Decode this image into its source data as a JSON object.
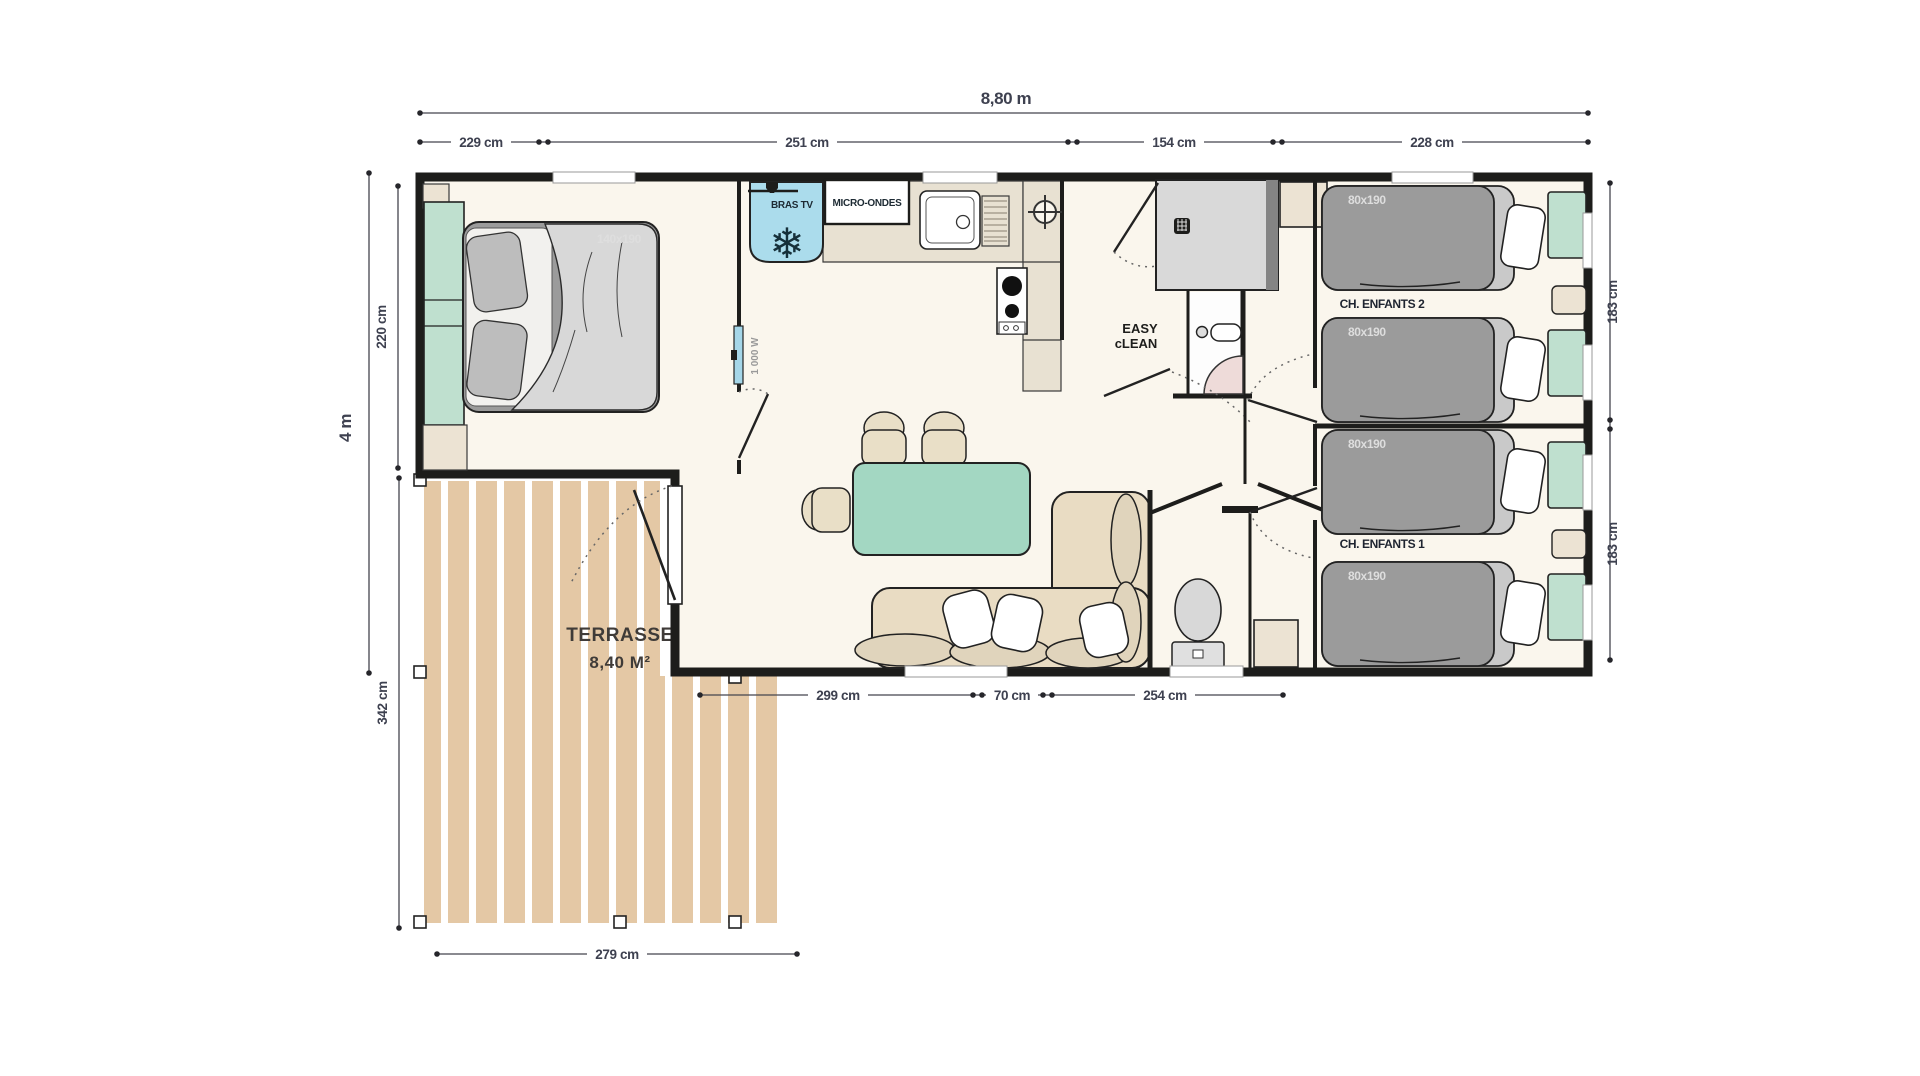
{
  "dimensions": {
    "total_width": "8,80 m",
    "top_segments": [
      "229 cm",
      "251 cm",
      "154 cm",
      "228 cm"
    ],
    "total_height": "4 m",
    "bedroom_height": "220 cm",
    "terrace_height": "342 cm",
    "right_segments": [
      "183 cm",
      "183 cm"
    ],
    "bottom_segments": [
      "299 cm",
      "70 cm",
      "254 cm"
    ],
    "terrace_width": "279 cm"
  },
  "rooms": {
    "terrace_name": "TERRASSE",
    "terrace_area": "8,40 M²",
    "kids_room_2": "CH. ENFANTS 2",
    "kids_room_1": "CH. ENFANTS 1"
  },
  "furniture": {
    "double_bed_size": "140x190",
    "single_beds": [
      "80x190",
      "80x190",
      "80x190",
      "80x190"
    ],
    "tv_bracket": "BRAS TV",
    "microwave": "MICRO-ONDES",
    "heater_power": "1 000 W",
    "brand_line1": "EASY",
    "brand_line2": "cLEAN"
  },
  "colors": {
    "wall": "#1d1d1b",
    "floor": "#faf6ed",
    "terrace_plank": "#e4c8a5",
    "furniture_green": "#bfe0cf",
    "table_teal": "#a3d7c2",
    "mattress_gray": "#9b9b9b",
    "beige": "#ece3d3",
    "fridge_blue": "#abdcec",
    "dim_text": "#3e4150"
  }
}
